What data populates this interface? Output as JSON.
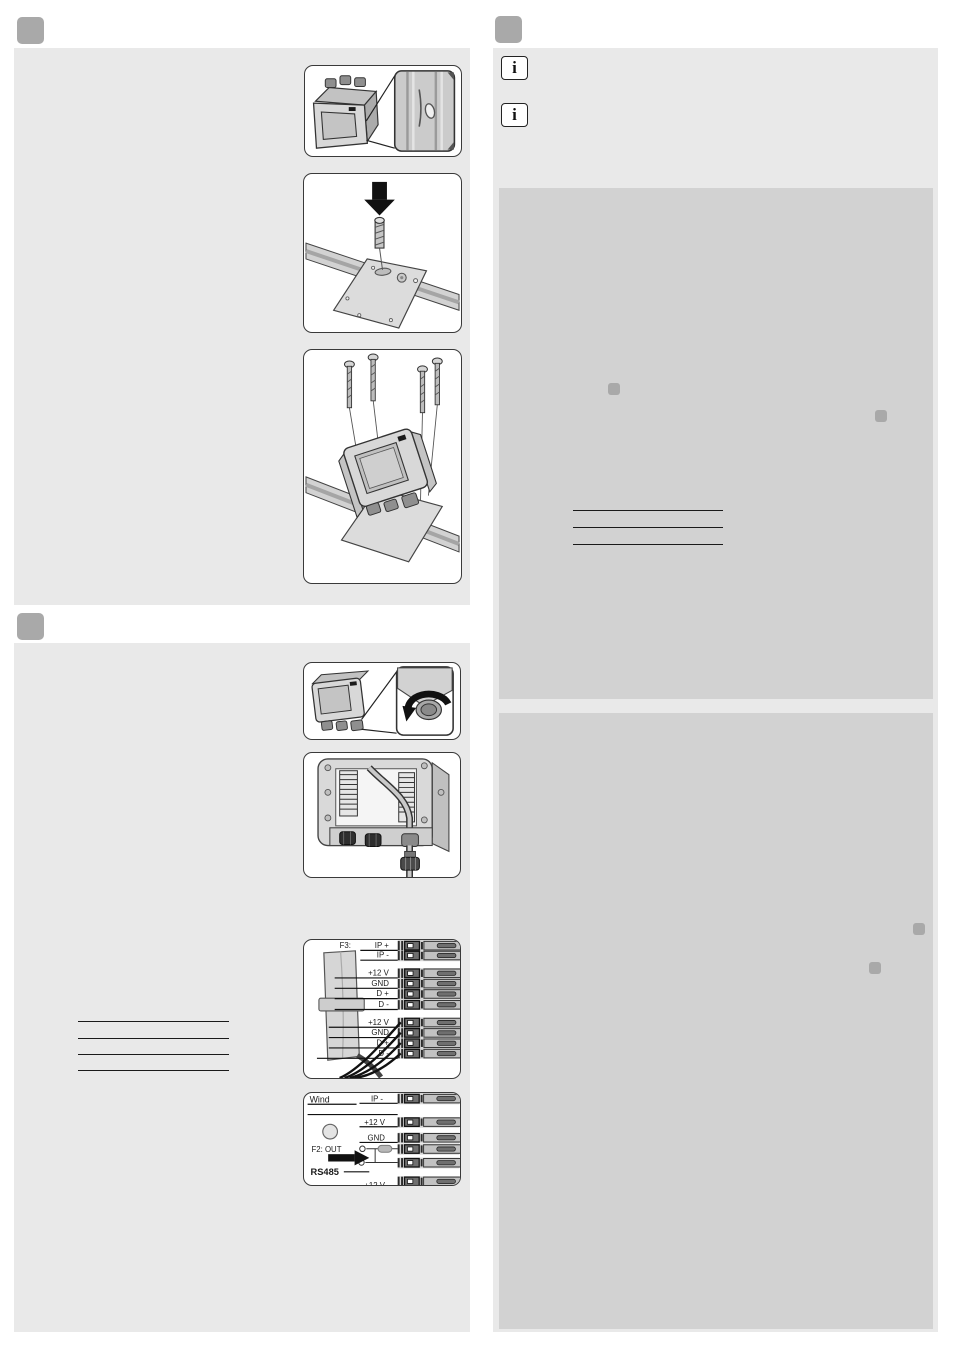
{
  "colors": {
    "page_bg": "#ffffff",
    "panel_light": "#e9e9e9",
    "panel_dark": "#d2d2d2",
    "marker_gray": "#a9a9a9",
    "rule_black": "#1a1a1a",
    "illustration_border": "#3a3a3a"
  },
  "info_notes": [
    {
      "icon_glyph": "i"
    },
    {
      "icon_glyph": "i"
    }
  ],
  "diagram_f3": {
    "header": "F3:",
    "group1": [
      "IP +",
      "IP -"
    ],
    "group2": [
      "+12 V",
      "GND",
      "D +",
      "D -"
    ],
    "group3": [
      "+12 V",
      "GND",
      "D +",
      "D -"
    ]
  },
  "diagram_wind": {
    "device_label": "Wind",
    "top_row": "IP -",
    "power_rows": [
      "+12 V",
      "GND"
    ],
    "output_label": "F2: OUT",
    "bus_label": "RS485",
    "bottom_row": "+12 V"
  }
}
